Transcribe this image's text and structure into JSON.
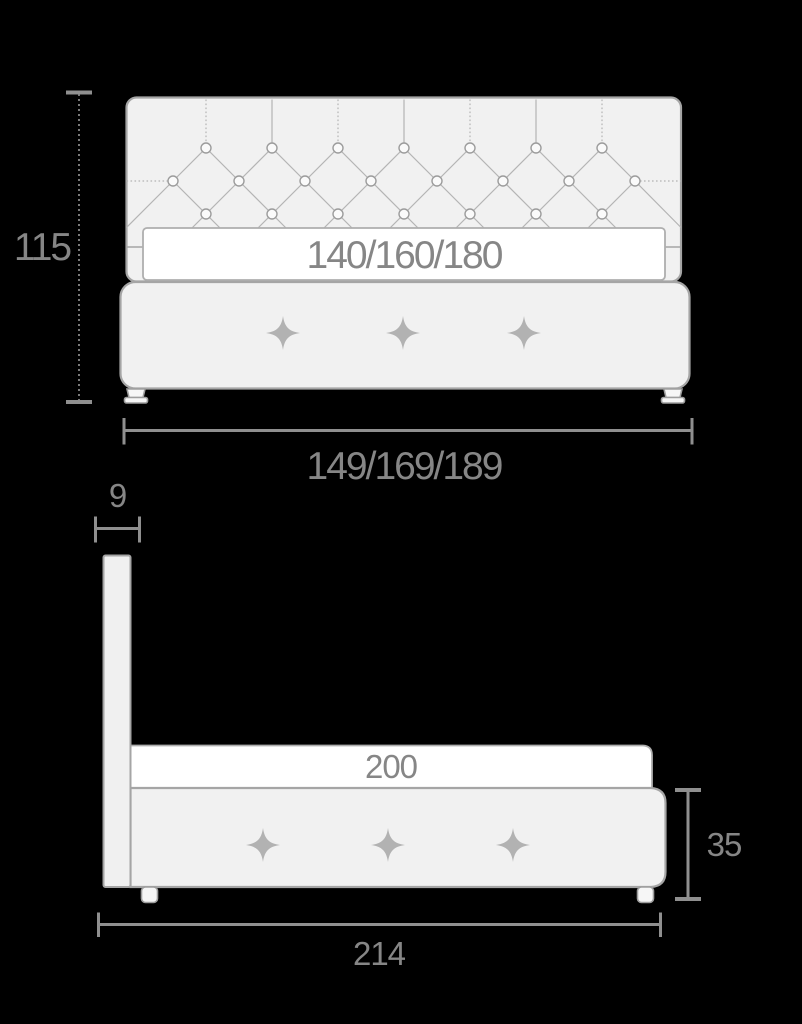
{
  "diagram": {
    "front_view": {
      "height_label": "115",
      "mattress_width_label": "140/160/180",
      "overall_width_label": "149/169/189"
    },
    "side_view": {
      "headboard_depth_label": "9",
      "mattress_length_label": "200",
      "base_height_label": "35",
      "overall_length_label": "214"
    },
    "colors": {
      "background": "#000000",
      "furniture_fill": "#f1f1f1",
      "mattress_fill": "#ffffff",
      "outline": "#a5a5a5",
      "dimension_line": "#8f8f8f",
      "label_text": "#868686"
    }
  }
}
